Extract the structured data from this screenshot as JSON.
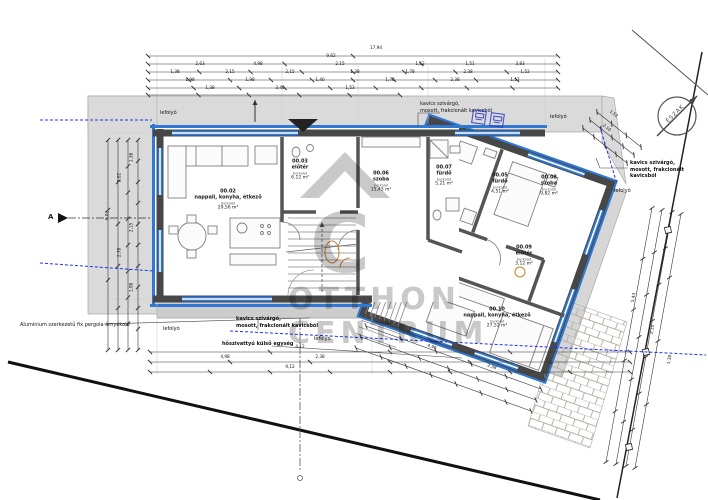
{
  "watermark": {
    "letter": "C",
    "line1": "OTTHON",
    "line2": "CENTRUM"
  },
  "north": {
    "label": "ÉSZAK"
  },
  "section": {
    "marker": "A"
  },
  "rooms": [
    {
      "id": "00.02",
      "name": "nappali, konyha, étkező",
      "sub": "burkolat",
      "area": "29,56 m²",
      "x": 228,
      "y": 200
    },
    {
      "id": "00.03",
      "name": "előtér",
      "sub": "burkolat",
      "area": "6,12 m²",
      "x": 300,
      "y": 170
    },
    {
      "id": "00.06",
      "name": "szoba",
      "sub": "burkolat",
      "area": "15,43 m²",
      "x": 381,
      "y": 182
    },
    {
      "id": "00.07",
      "name": "fürdő",
      "sub": "burkolat",
      "area": "5,21 m²",
      "x": 444,
      "y": 176
    },
    {
      "id": "00.05",
      "name": "fürdő",
      "sub": "burkolat",
      "area": "4,51 m²",
      "x": 500,
      "y": 184
    },
    {
      "id": "00.08",
      "name": "szoba",
      "sub": "burkolat",
      "area": "9,82 m²",
      "x": 549,
      "y": 186
    },
    {
      "id": "00.09",
      "name": "előtér",
      "sub": "burkolat",
      "area": "3,12 m²",
      "x": 524,
      "y": 256
    },
    {
      "id": "00.10",
      "name": "nappali, konyha, étkező",
      "sub": "burkolat",
      "area": "27,52 m²",
      "x": 497,
      "y": 318
    }
  ],
  "annotations": [
    {
      "text": "kavics szivárgó,\nmosott, frakcionált kavicsból",
      "x": 420,
      "y": 101,
      "align": "left",
      "bold": false
    },
    {
      "text": "kavics szivárgó,\nmosott, frakcionált kavicsból",
      "x": 630,
      "y": 160,
      "align": "left",
      "bold": true
    },
    {
      "text": "kavics szivárgó,\nmosott, frakcionált kavicsból",
      "x": 236,
      "y": 316,
      "align": "left",
      "bold": true
    },
    {
      "text": "Alumínium szerkezetű fix pergola árnyékoló",
      "x": 20,
      "y": 322,
      "align": "left",
      "bold": false
    },
    {
      "text": "hőszivattyú külső egység",
      "x": 222,
      "y": 341,
      "align": "left",
      "bold": true
    },
    {
      "text": "lefolyó",
      "x": 160,
      "y": 110,
      "align": "left",
      "bold": false
    },
    {
      "text": "lefolyó",
      "x": 550,
      "y": 114,
      "align": "left",
      "bold": false
    },
    {
      "text": "lefolyó",
      "x": 614,
      "y": 188,
      "align": "left",
      "bold": false
    },
    {
      "text": "lefolyó",
      "x": 163,
      "y": 326,
      "align": "left",
      "bold": false
    },
    {
      "text": "lefolyó",
      "x": 314,
      "y": 336,
      "align": "left",
      "bold": false
    }
  ],
  "dims": [
    {
      "x": 376,
      "y": 50,
      "t": "17,94",
      "r": 0
    },
    {
      "x": 331,
      "y": 58,
      "t": "9,62",
      "r": 0
    },
    {
      "x": 200,
      "y": 66,
      "t": "2,63",
      "r": 0
    },
    {
      "x": 258,
      "y": 66,
      "t": "4,98",
      "r": 0
    },
    {
      "x": 340,
      "y": 66,
      "t": "2,15",
      "r": 0
    },
    {
      "x": 420,
      "y": 66,
      "t": "1,52",
      "r": 0
    },
    {
      "x": 470,
      "y": 66,
      "t": "1,51",
      "r": 0
    },
    {
      "x": 520,
      "y": 66,
      "t": "3,83",
      "r": 0
    },
    {
      "x": 175,
      "y": 74,
      "t": "1,38",
      "r": 0
    },
    {
      "x": 230,
      "y": 74,
      "t": "2,15",
      "r": 0
    },
    {
      "x": 290,
      "y": 74,
      "t": "2,15",
      "r": 0
    },
    {
      "x": 355,
      "y": 74,
      "t": "1,38",
      "r": 0
    },
    {
      "x": 410,
      "y": 74,
      "t": "1,78",
      "r": 0
    },
    {
      "x": 468,
      "y": 74,
      "t": "2,38",
      "r": 0
    },
    {
      "x": 525,
      "y": 74,
      "t": "1,52",
      "r": 0
    },
    {
      "x": 190,
      "y": 82,
      "t": "1,98",
      "r": 0
    },
    {
      "x": 250,
      "y": 82,
      "t": "1,98",
      "r": 0
    },
    {
      "x": 320,
      "y": 82,
      "t": "1,40",
      "r": 0
    },
    {
      "x": 390,
      "y": 82,
      "t": "1,78",
      "r": 0
    },
    {
      "x": 455,
      "y": 82,
      "t": "2,38",
      "r": 0
    },
    {
      "x": 515,
      "y": 82,
      "t": "1,57",
      "r": 0
    },
    {
      "x": 210,
      "y": 90,
      "t": "1,38",
      "r": 0
    },
    {
      "x": 280,
      "y": 90,
      "t": "3,40",
      "r": 0
    },
    {
      "x": 350,
      "y": 90,
      "t": "1,53",
      "r": 0
    },
    {
      "x": 107,
      "y": 218,
      "t": "6,02",
      "r": -90
    },
    {
      "x": 119,
      "y": 180,
      "t": "2,62",
      "r": -90
    },
    {
      "x": 119,
      "y": 255,
      "t": "2,78",
      "r": -90
    },
    {
      "x": 131,
      "y": 160,
      "t": "1,38",
      "r": -90
    },
    {
      "x": 131,
      "y": 230,
      "t": "2,15",
      "r": -90
    },
    {
      "x": 131,
      "y": 290,
      "t": "1,98",
      "r": -90
    },
    {
      "x": 300,
      "y": 349,
      "t": "4,12",
      "r": 0
    },
    {
      "x": 225,
      "y": 359,
      "t": "4,98",
      "r": 0
    },
    {
      "x": 320,
      "y": 359,
      "t": "2,38",
      "r": 0
    },
    {
      "x": 290,
      "y": 369,
      "t": "9,12",
      "r": 0
    },
    {
      "x": 633,
      "y": 300,
      "t": "5,43",
      "r": -80
    },
    {
      "x": 652,
      "y": 332,
      "t": "2,15",
      "r": -80
    },
    {
      "x": 669,
      "y": 362,
      "t": "1,38",
      "r": -80
    },
    {
      "x": 614,
      "y": 116,
      "t": "1,52",
      "r": 38
    },
    {
      "x": 607,
      "y": 130,
      "t": "2,10",
      "r": 38
    },
    {
      "x": 432,
      "y": 349,
      "t": "4,98",
      "r": 20
    },
    {
      "x": 492,
      "y": 369,
      "t": "2,38",
      "r": 20
    }
  ]
}
